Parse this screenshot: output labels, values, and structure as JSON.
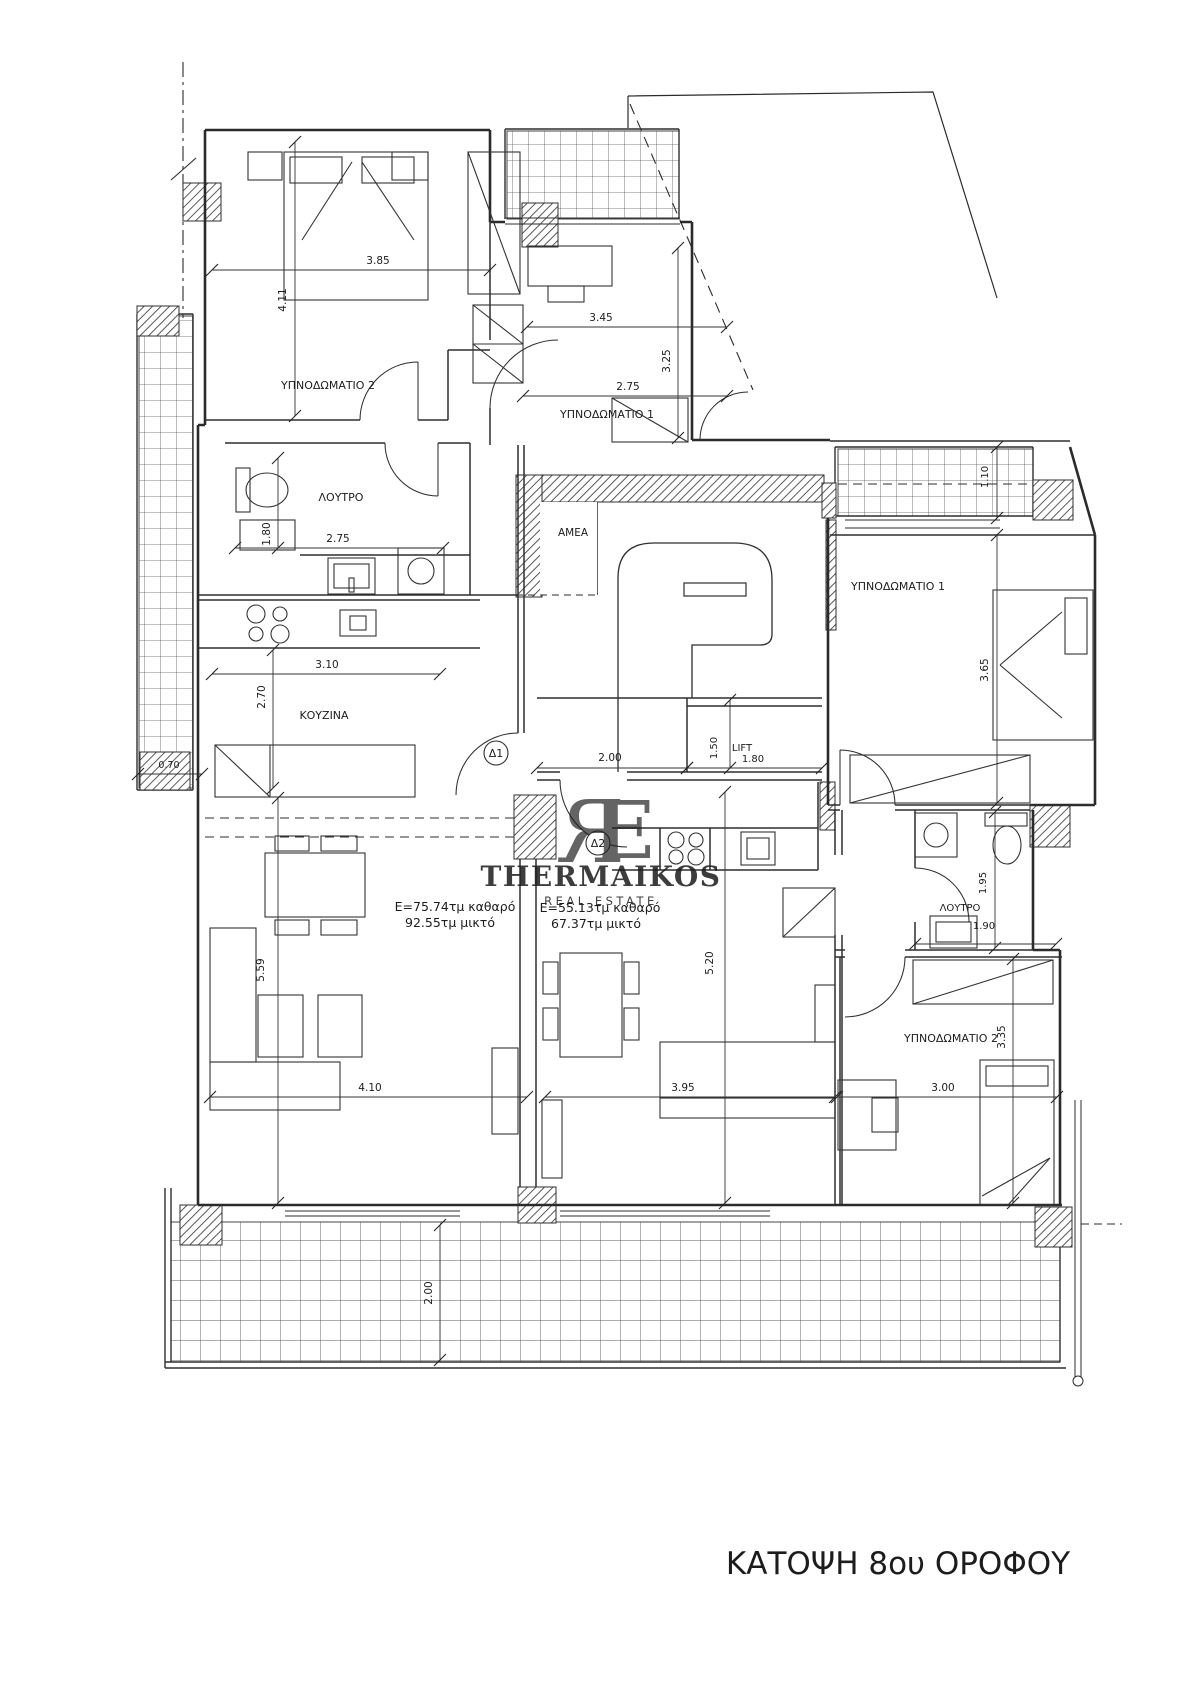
{
  "title": "ΚΑΤΟΨΗ 8ου ΟΡΟΦΟΥ",
  "watermark": {
    "name": "THERMAIKOS",
    "tagline": "REAL ESTATE",
    "monogram_left": "R",
    "monogram_right": "E",
    "monogram_color": "#c8b39a",
    "name_color": "#8f8f8f",
    "tagline_color": "#bdbdbd"
  },
  "apartments": [
    {
      "door_label": "Δ1",
      "area_line1": "E=75.74τμ καθαρό",
      "area_line2": "92.55τμ μικτό"
    },
    {
      "door_label": "Δ2",
      "area_line1": "E=55.13τμ καθαρό",
      "area_line2": "67.37τμ μικτό"
    }
  ],
  "rooms": {
    "left_bedroom2": "ΥΠΝΟΔΩΜΑΤΙΟ 2",
    "left_bedroom1": "ΥΠΝΟΔΩΜΑΤΙΟ 1",
    "left_bath": "ΛΟΥΤΡΟ",
    "left_kitchen": "ΚΟΥΖΙΝΑ",
    "amea": "AMEA",
    "lift": "LIFT",
    "right_bedroom1": "ΥΠΝΟΔΩΜΑΤΙΟ 1",
    "right_bath": "ΛΟΥΤΡΟ",
    "right_bedroom2": "ΥΠΝΟΔΩΜΑΤΙΟ 2"
  },
  "dimensions": {
    "left_bedroom2_w": "3.85",
    "left_bedroom2_h": "4.11",
    "left_bedroom1_w": "3.45",
    "left_bedroom1_h": "3.25",
    "left_bedroom1_w2": "2.75",
    "left_bath_h": "1.80",
    "left_bath_w": "2.75",
    "left_kitchen_w": "3.10",
    "left_kitchen_h": "2.70",
    "left_balcony_w": "0.70",
    "core_w": "2.00",
    "lift_h": "1.50",
    "lift_w": "1.80",
    "left_living_h": "5.59",
    "left_living_w": "4.10",
    "bottom_balcony_h": "2.00",
    "right_balcony_h": "1.10",
    "right_bedroom1_h": "3.65",
    "right_bath_h": "1.95",
    "right_bath_w": "1.90",
    "right_bedroom2_h": "3.35",
    "right_bedroom2_w": "3.00",
    "mid_living_h": "5.20",
    "mid_living_w": "3.95"
  }
}
